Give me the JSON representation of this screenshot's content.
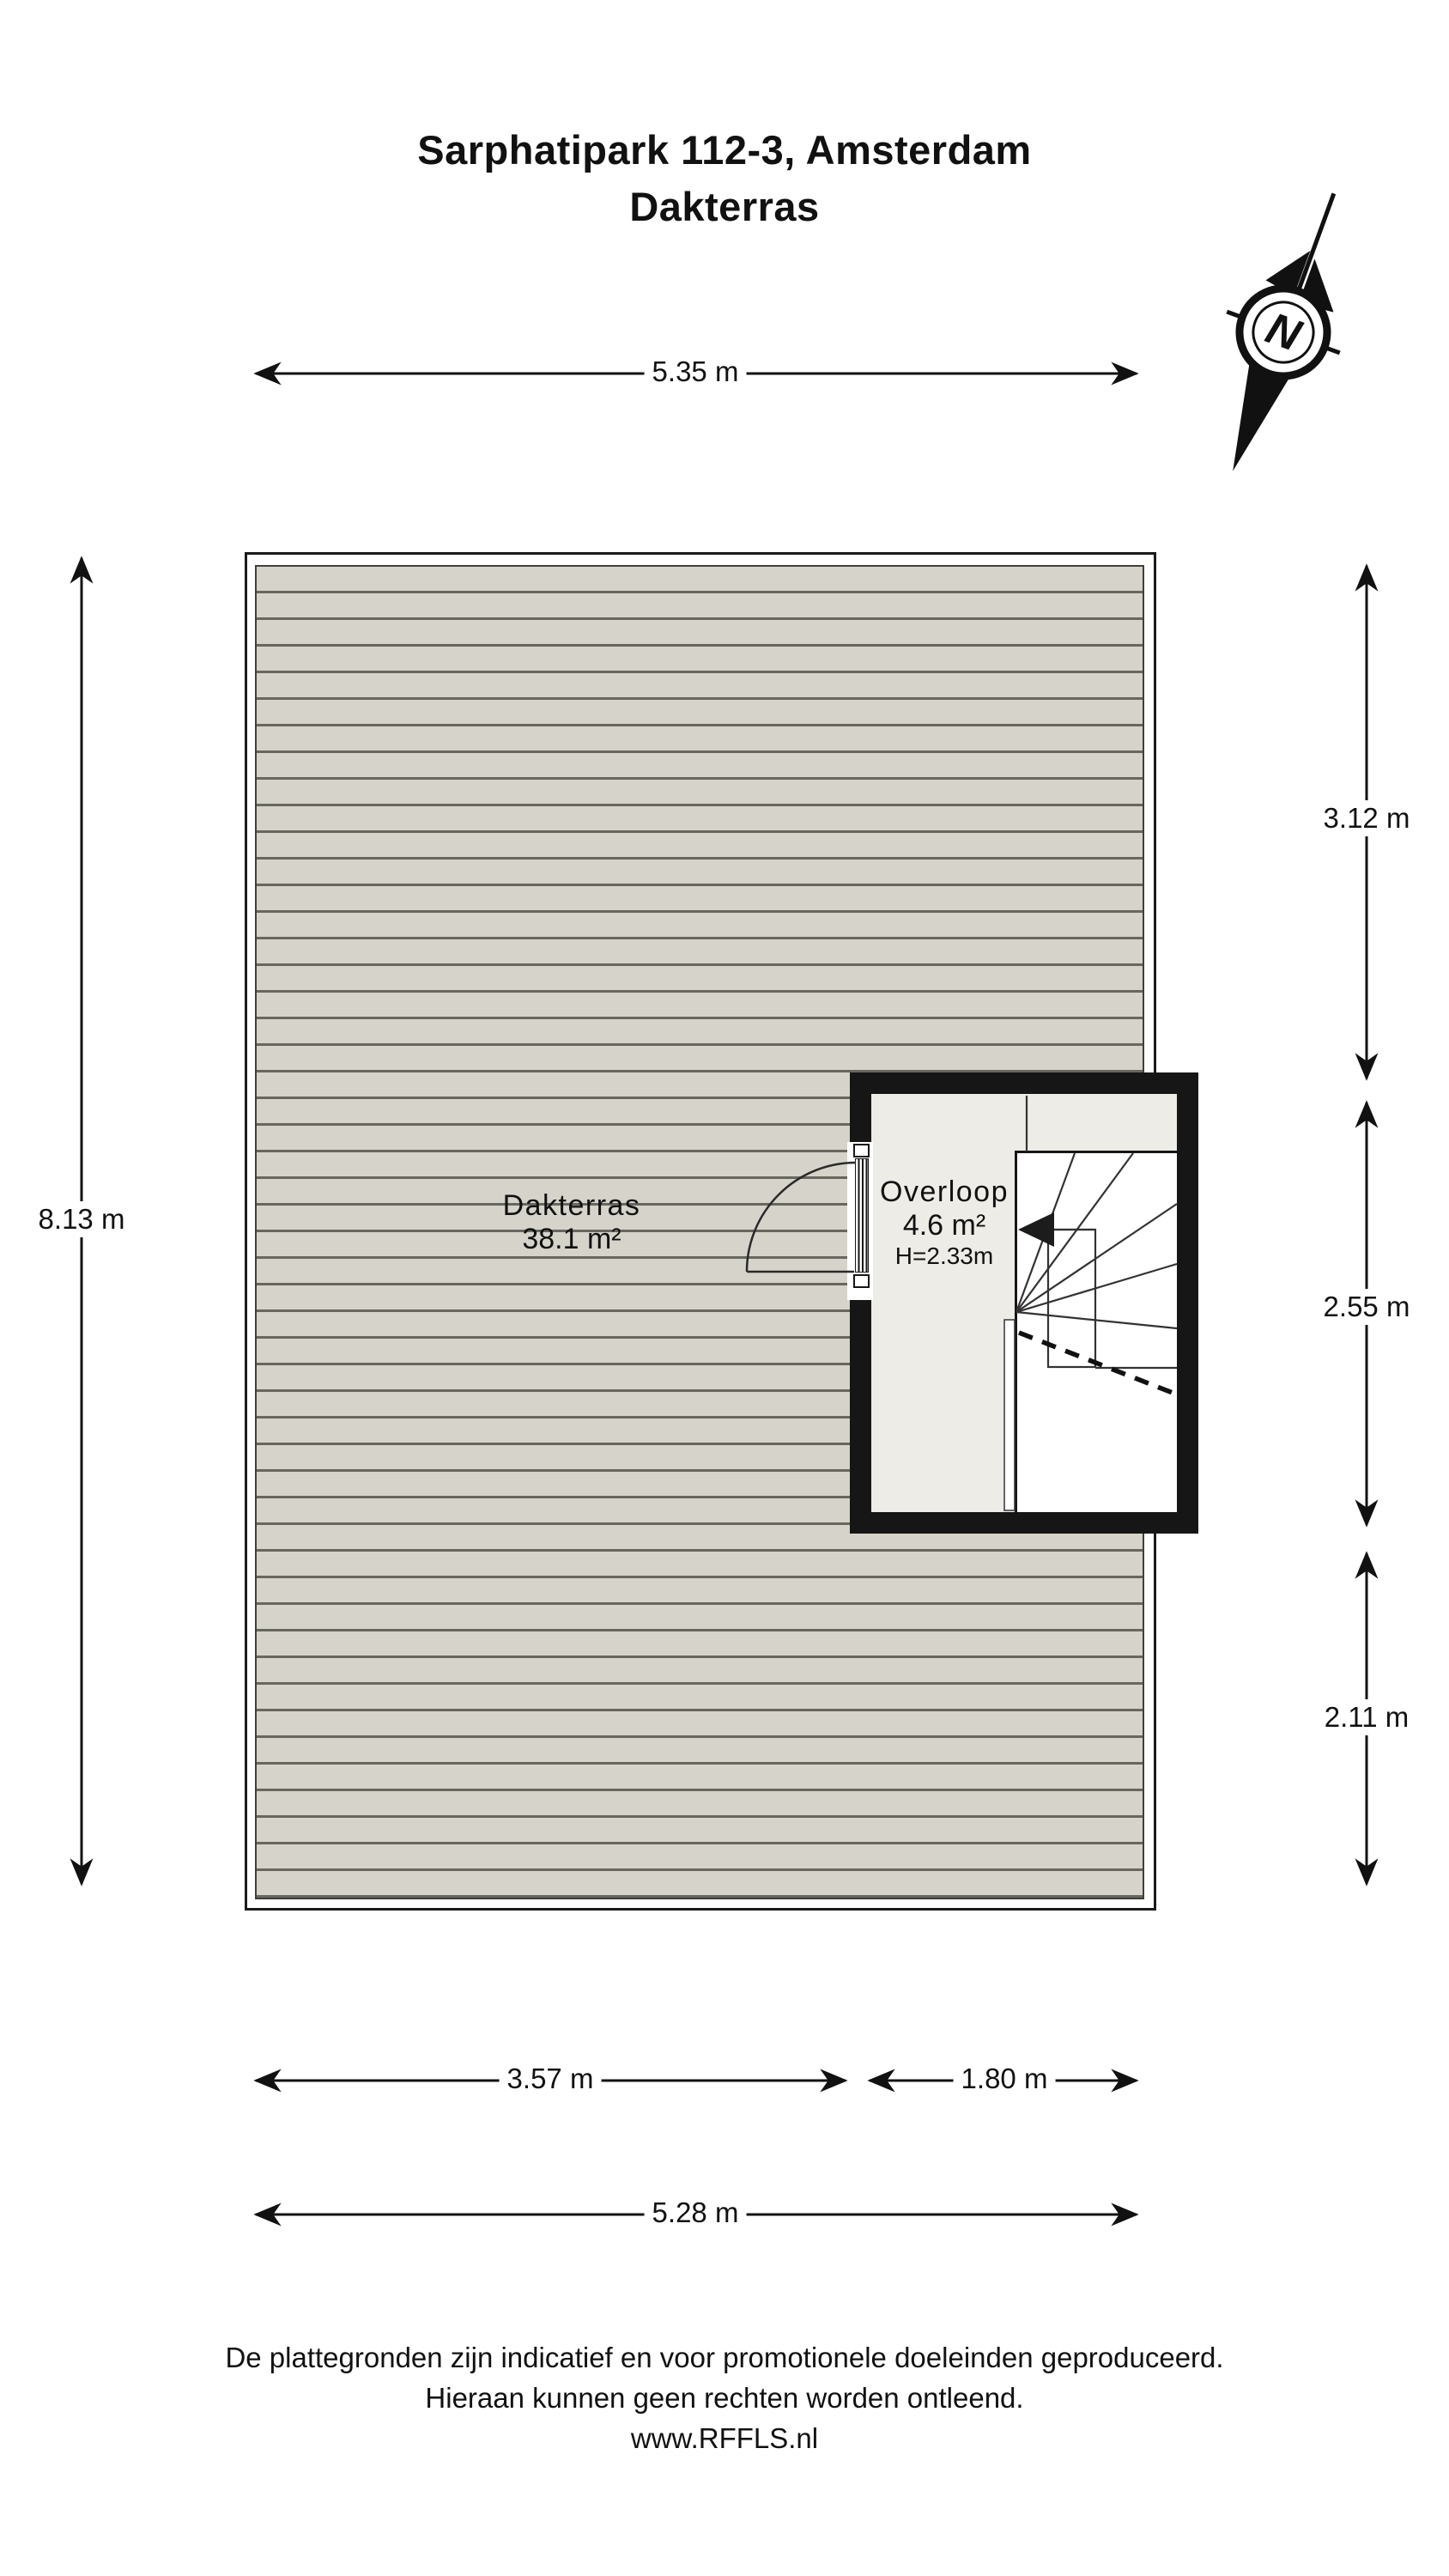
{
  "title": {
    "line1": "Sarphatipark 112-3, Amsterdam",
    "line2": "Dakterras"
  },
  "compass": {
    "label": "N"
  },
  "dimensions": {
    "top": "5.35 m",
    "left": "8.13 m",
    "right": [
      "3.12 m",
      "2.55 m",
      "2.11 m"
    ],
    "bottom_row1": [
      "3.57 m",
      "1.80 m"
    ],
    "bottom_row2": "5.28 m"
  },
  "rooms": {
    "dakterras": {
      "name": "Dakterras",
      "area": "38.1 m²"
    },
    "overloop": {
      "name": "Overloop",
      "area": "4.6 m²",
      "height": "H=2.33m"
    }
  },
  "footer": {
    "line1": "De plattegronden zijn indicatief en voor promotionele doeleinden geproduceerd.",
    "line2": "Hieraan kunnen geen rechten worden ontleend.",
    "line3": "www.RFFLS.nl"
  },
  "colors": {
    "deck": "#d6d4ca",
    "deck_line": "#68675f",
    "wall": "#161616",
    "floor": "#edece6",
    "outline": "#1a1a1a"
  }
}
